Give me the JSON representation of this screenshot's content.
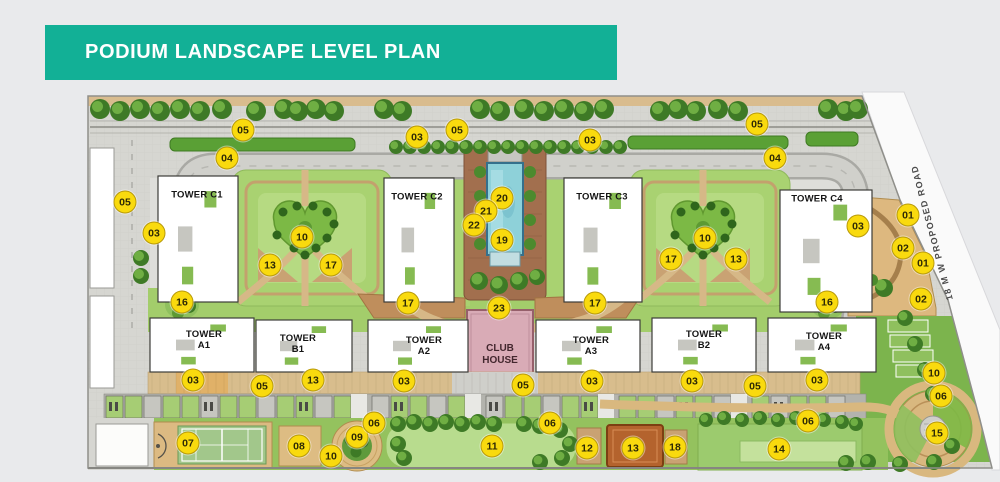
{
  "header": {
    "title": "PODIUM LANDSCAPE LEVEL PLAN"
  },
  "plan": {
    "road_label": "18 M W PROPOSED ROAD",
    "club_house_label": "CLUB HOUSE",
    "towers": [
      {
        "label": "TOWER C1",
        "x": 197,
        "y": 196,
        "stacked": false
      },
      {
        "label": "TOWER C2",
        "x": 417,
        "y": 198,
        "stacked": false
      },
      {
        "label": "TOWER C3",
        "x": 602,
        "y": 198,
        "stacked": false
      },
      {
        "label": "TOWER C4",
        "x": 817,
        "y": 200,
        "stacked": false
      },
      {
        "label": "TOWER A1",
        "x": 204,
        "y": 341,
        "stacked": true
      },
      {
        "label": "TOWER B1",
        "x": 298,
        "y": 345,
        "stacked": true
      },
      {
        "label": "TOWER A2",
        "x": 424,
        "y": 347,
        "stacked": true
      },
      {
        "label": "TOWER A3",
        "x": 591,
        "y": 347,
        "stacked": true
      },
      {
        "label": "TOWER B2",
        "x": 704,
        "y": 341,
        "stacked": true
      },
      {
        "label": "TOWER A4",
        "x": 824,
        "y": 343,
        "stacked": true
      }
    ],
    "markers": [
      {
        "label": "05",
        "x": 243,
        "y": 130
      },
      {
        "label": "03",
        "x": 417,
        "y": 137
      },
      {
        "label": "05",
        "x": 457,
        "y": 130
      },
      {
        "label": "03",
        "x": 590,
        "y": 140
      },
      {
        "label": "05",
        "x": 757,
        "y": 124
      },
      {
        "label": "04",
        "x": 227,
        "y": 158
      },
      {
        "label": "04",
        "x": 775,
        "y": 158
      },
      {
        "label": "05",
        "x": 125,
        "y": 202
      },
      {
        "label": "03",
        "x": 154,
        "y": 233
      },
      {
        "label": "03",
        "x": 858,
        "y": 226
      },
      {
        "label": "01",
        "x": 908,
        "y": 215
      },
      {
        "label": "02",
        "x": 903,
        "y": 248
      },
      {
        "label": "01",
        "x": 923,
        "y": 263
      },
      {
        "label": "02",
        "x": 921,
        "y": 299
      },
      {
        "label": "10",
        "x": 302,
        "y": 237
      },
      {
        "label": "13",
        "x": 270,
        "y": 265
      },
      {
        "label": "17",
        "x": 331,
        "y": 265
      },
      {
        "label": "10",
        "x": 705,
        "y": 238
      },
      {
        "label": "17",
        "x": 671,
        "y": 259
      },
      {
        "label": "13",
        "x": 736,
        "y": 259
      },
      {
        "label": "20",
        "x": 502,
        "y": 198
      },
      {
        "label": "21",
        "x": 486,
        "y": 211
      },
      {
        "label": "22",
        "x": 474,
        "y": 225
      },
      {
        "label": "19",
        "x": 502,
        "y": 240
      },
      {
        "label": "16",
        "x": 182,
        "y": 302
      },
      {
        "label": "17",
        "x": 408,
        "y": 303
      },
      {
        "label": "23",
        "x": 499,
        "y": 308
      },
      {
        "label": "17",
        "x": 595,
        "y": 303
      },
      {
        "label": "16",
        "x": 827,
        "y": 302
      },
      {
        "label": "03",
        "x": 193,
        "y": 380
      },
      {
        "label": "05",
        "x": 262,
        "y": 386
      },
      {
        "label": "13",
        "x": 313,
        "y": 380
      },
      {
        "label": "03",
        "x": 404,
        "y": 381
      },
      {
        "label": "05",
        "x": 523,
        "y": 385
      },
      {
        "label": "03",
        "x": 592,
        "y": 381
      },
      {
        "label": "03",
        "x": 692,
        "y": 381
      },
      {
        "label": "05",
        "x": 755,
        "y": 386
      },
      {
        "label": "03",
        "x": 817,
        "y": 380
      },
      {
        "label": "10",
        "x": 934,
        "y": 373
      },
      {
        "label": "06",
        "x": 941,
        "y": 396
      },
      {
        "label": "07",
        "x": 188,
        "y": 443
      },
      {
        "label": "08",
        "x": 299,
        "y": 446
      },
      {
        "label": "10",
        "x": 331,
        "y": 456
      },
      {
        "label": "09",
        "x": 357,
        "y": 437
      },
      {
        "label": "06",
        "x": 374,
        "y": 423
      },
      {
        "label": "11",
        "x": 492,
        "y": 446
      },
      {
        "label": "06",
        "x": 550,
        "y": 423
      },
      {
        "label": "12",
        "x": 587,
        "y": 448
      },
      {
        "label": "13",
        "x": 633,
        "y": 448
      },
      {
        "label": "18",
        "x": 675,
        "y": 447
      },
      {
        "label": "06",
        "x": 808,
        "y": 421
      },
      {
        "label": "14",
        "x": 779,
        "y": 449
      },
      {
        "label": "15",
        "x": 937,
        "y": 433
      }
    ]
  },
  "colors": {
    "banner_teal": "#12b096",
    "marker_yellow": "#f9da0e",
    "marker_border": "#b89a0a",
    "club_house_pink": "#d9abb6",
    "lawn_green": "#a9d271",
    "path_tan": "#c9a273",
    "pool_blue": "#8ed1d9"
  }
}
